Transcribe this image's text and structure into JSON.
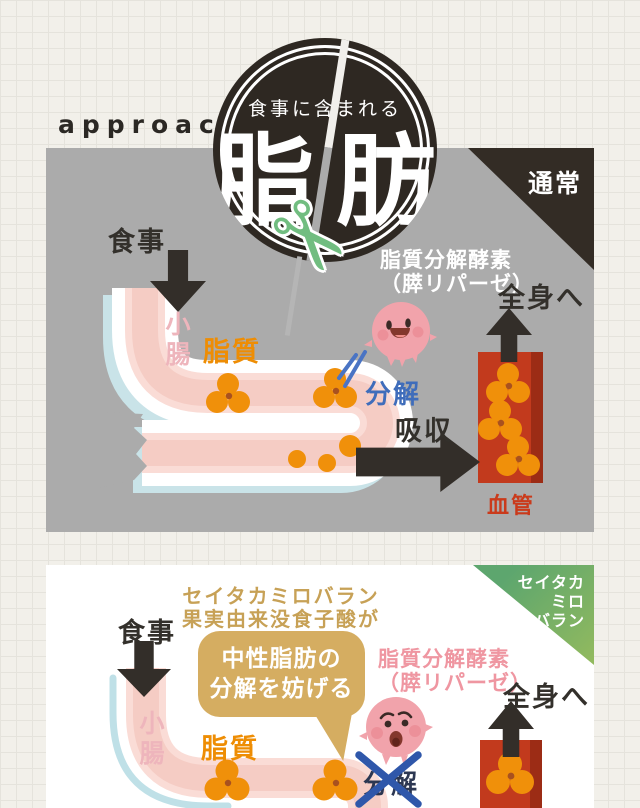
{
  "page": {
    "approach_label": "approach"
  },
  "badge": {
    "subtitle": "食事に含まれる",
    "title_left": "脂",
    "title_right": "肪",
    "scissors_icon": "✂"
  },
  "panel_normal": {
    "corner_label": "通常",
    "meal_label": "食事",
    "small_intestine_label": "小腸",
    "lipid_label": "脂質",
    "enzyme_label_line1": "脂質分解酵素",
    "enzyme_label_line2": "（膵リパーゼ）",
    "breakdown_label": "分解",
    "absorption_label": "吸収",
    "blood_vessel_label": "血管",
    "systemic_label": "全身へ"
  },
  "panel_seitaka": {
    "corner_label_line1": "セイタカ",
    "corner_label_line2": "ミロ",
    "corner_label_line3": "バラン",
    "headline_line1": "セイタカミロバラン",
    "headline_line2": "果実由来没食子酸が",
    "bubble_line1": "中性脂肪の",
    "bubble_line2": "分解を妨げる",
    "enzyme_label_line1": "脂質分解酵素",
    "enzyme_label_line2": "（膵リパーゼ）",
    "meal_label": "食事",
    "small_intestine_label": "小腸",
    "lipid_label": "脂質",
    "breakdown_label": "分解",
    "systemic_label": "全身へ"
  },
  "colors": {
    "panel_gray": "#ababab",
    "badge_dark": "#2e2822",
    "tube_pink": "#f5ccc4",
    "tube_shadow_blue": "#c9e3e8",
    "fat_orange": "#f0900a",
    "vessel_red": "#c23a1d",
    "scissors_green": "#71bd80",
    "corner_green": "#5da66e",
    "bubble_tan": "#d5ad61",
    "breakdown_blue": "#3f6dbb",
    "character_pink": "#f1a3ab"
  }
}
